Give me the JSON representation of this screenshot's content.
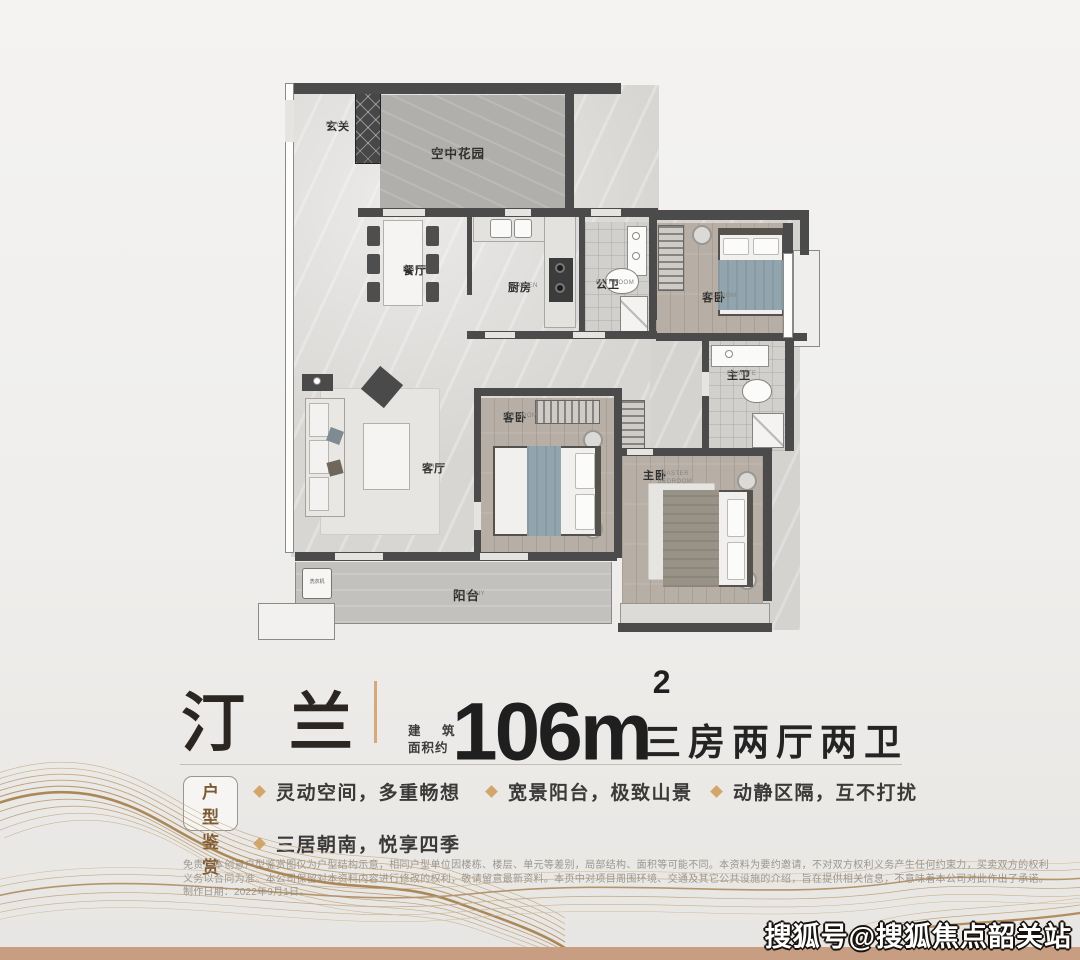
{
  "floorplan": {
    "rooms": [
      {
        "zh": "玄关",
        "en": "FOYER"
      },
      {
        "zh": "空中花园",
        "en": "BALCONY"
      },
      {
        "zh": "餐厅",
        "en": "DINING"
      },
      {
        "zh": "厨房",
        "en": "KITCHEN"
      },
      {
        "zh": "公卫",
        "en": "BATHROOM"
      },
      {
        "zh": "客卧",
        "en": "BEDROOM"
      },
      {
        "zh": "客厅",
        "en": "LIVING"
      },
      {
        "zh": "客卧",
        "en": "BEDROOM"
      },
      {
        "zh": "主卫",
        "en": "ENSUITE"
      },
      {
        "zh": "主卧",
        "en": "MASTER BEDROOM"
      },
      {
        "zh": "阳台",
        "en": "BALCONY"
      },
      {
        "zh": "洗衣机",
        "en": ""
      }
    ]
  },
  "title": {
    "name": "汀 兰",
    "area_label_line1": "建 筑",
    "area_label_line2": "面积约",
    "area_value": "106m",
    "area_exponent": "2",
    "layout_desc": "三房两厅两卫"
  },
  "features": {
    "badge_line1": "户 型",
    "badge_line2": "鉴 赏",
    "items": [
      "灵动空间，多重畅想",
      "宽景阳台，极致山景",
      "动静区隔，互不打扰",
      "三居朝南，悦享四季"
    ]
  },
  "disclaimer": "免责：本创意户型鉴赏图仅为户型结构示意，相同户型单位因楼栋、楼层、单元等差别，局部结构、面积等可能不同。本资料为要约邀请，不对双方权利义务产生任何约束力，买卖双方的权利义务以合同为准。本公司保留对本资料内容进行修改的权利，敬请留意最新资料。本页中对项目周围环境、交通及其它公共设施的介绍，旨在提供相关信息，不意味着本公司对此作出了承诺。制作日期：2022年9月1日。",
  "watermark": "搜狐号@搜狐焦点韶关站",
  "colors": {
    "accent_gold": "#d2a56b",
    "divider_gold": "#d9a87a",
    "bottom_strip": "#c89e82",
    "title_text": "#2b2622",
    "badge_text": "#7d5a36"
  }
}
